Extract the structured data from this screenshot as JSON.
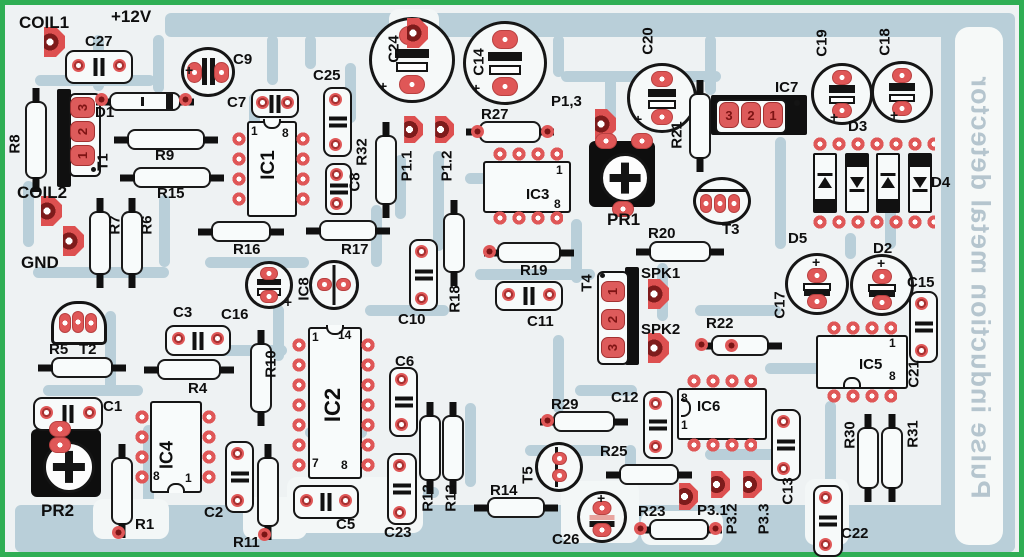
{
  "title": {
    "text": "Pulse induction metal detector"
  },
  "colors": {
    "border_green": "#2fae54",
    "board_bg": "#eef2f3",
    "trace_blue": "#b9cfd9",
    "pad_red": "#df5757",
    "component_outline": "#151515",
    "title_text": "#b5c5ce"
  },
  "labels": {
    "coil1": "COIL1",
    "coil2": "COIL2",
    "gnd": "GND",
    "plus12v": "+12V",
    "c1": "C1",
    "c2": "C2",
    "c3": "C3",
    "c5": "C5",
    "c6": "C6",
    "c7": "C7",
    "c8": "C8",
    "c9": "C9",
    "c10": "C10",
    "c11": "C11",
    "c12": "C12",
    "c13": "C13",
    "c14": "C14",
    "c15": "C15",
    "c16": "C16",
    "c17": "C17",
    "c18": "C18",
    "c19": "C19",
    "c20": "C20",
    "c21": "C21",
    "c22": "C22",
    "c23": "C23",
    "c24": "C24",
    "c25": "C25",
    "c26": "C26",
    "c27": "C27",
    "d1": "D1",
    "d2": "D2",
    "d3": "D3",
    "d4": "D4",
    "d5": "D5",
    "r1": "R1",
    "r4": "R4",
    "r5": "R5",
    "r6": "R6",
    "r7": "R7",
    "r8": "R8",
    "r9": "R9",
    "r10": "R10",
    "r11": "R11",
    "r12": "R12",
    "r13": "R13",
    "r14": "R14",
    "r15": "R15",
    "r16": "R16",
    "r17": "R17",
    "r18": "R18",
    "r19": "R19",
    "r20": "R20",
    "r21": "R21",
    "r22": "R22",
    "r23": "R23",
    "r25": "R25",
    "r27": "R27",
    "r29": "R29",
    "r30": "R30",
    "r31": "R31",
    "r32": "R32",
    "t1": "T1",
    "t2": "T2",
    "t3": "T3",
    "t4": "T4",
    "t5": "T5",
    "ic1": "IC1",
    "ic2": "IC2",
    "ic3": "IC3",
    "ic4": "IC4",
    "ic5": "IC5",
    "ic6": "IC6",
    "ic7": "IC7",
    "ic8": "IC8",
    "pr1": "PR1",
    "pr2": "PR2",
    "spk1": "SPK1",
    "spk2": "SPK2",
    "p11": "P1.1",
    "p12": "P1.2",
    "p13": "P1,3",
    "p31": "P3.1",
    "p32": "P3.2",
    "p33": "P3.3"
  },
  "pins": {
    "n1": "1",
    "n2": "2",
    "n3": "3",
    "n7": "7",
    "n8": "8",
    "n14": "14",
    "plus": "+"
  }
}
